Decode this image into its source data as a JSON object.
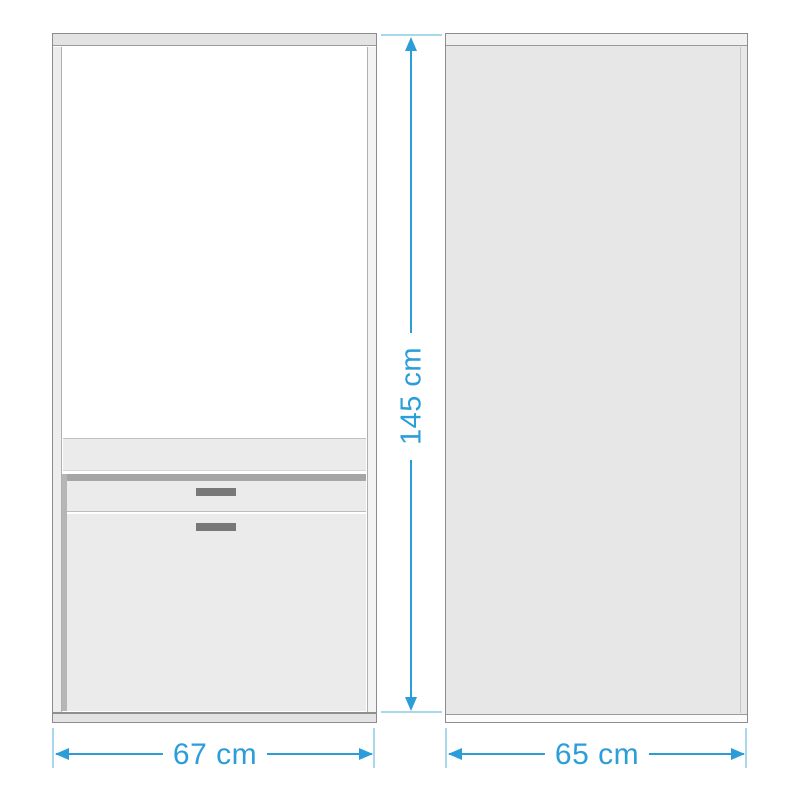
{
  "diagram": {
    "kind": "furniture-dimension-drawing",
    "dimensions": {
      "height": {
        "label": "145 cm"
      },
      "front_width": {
        "label": "67 cm"
      },
      "side_depth": {
        "label": "65 cm"
      }
    },
    "colors": {
      "dimension_line": "#2b9dd9",
      "extension_line": "#a9d7eb",
      "cabinet_border": "#8c8c8c",
      "panel_fill": "#ebebeb",
      "side_fill": "#e7e7e7",
      "dark_strip": "#a6a6a6",
      "handle": "#787878"
    }
  }
}
